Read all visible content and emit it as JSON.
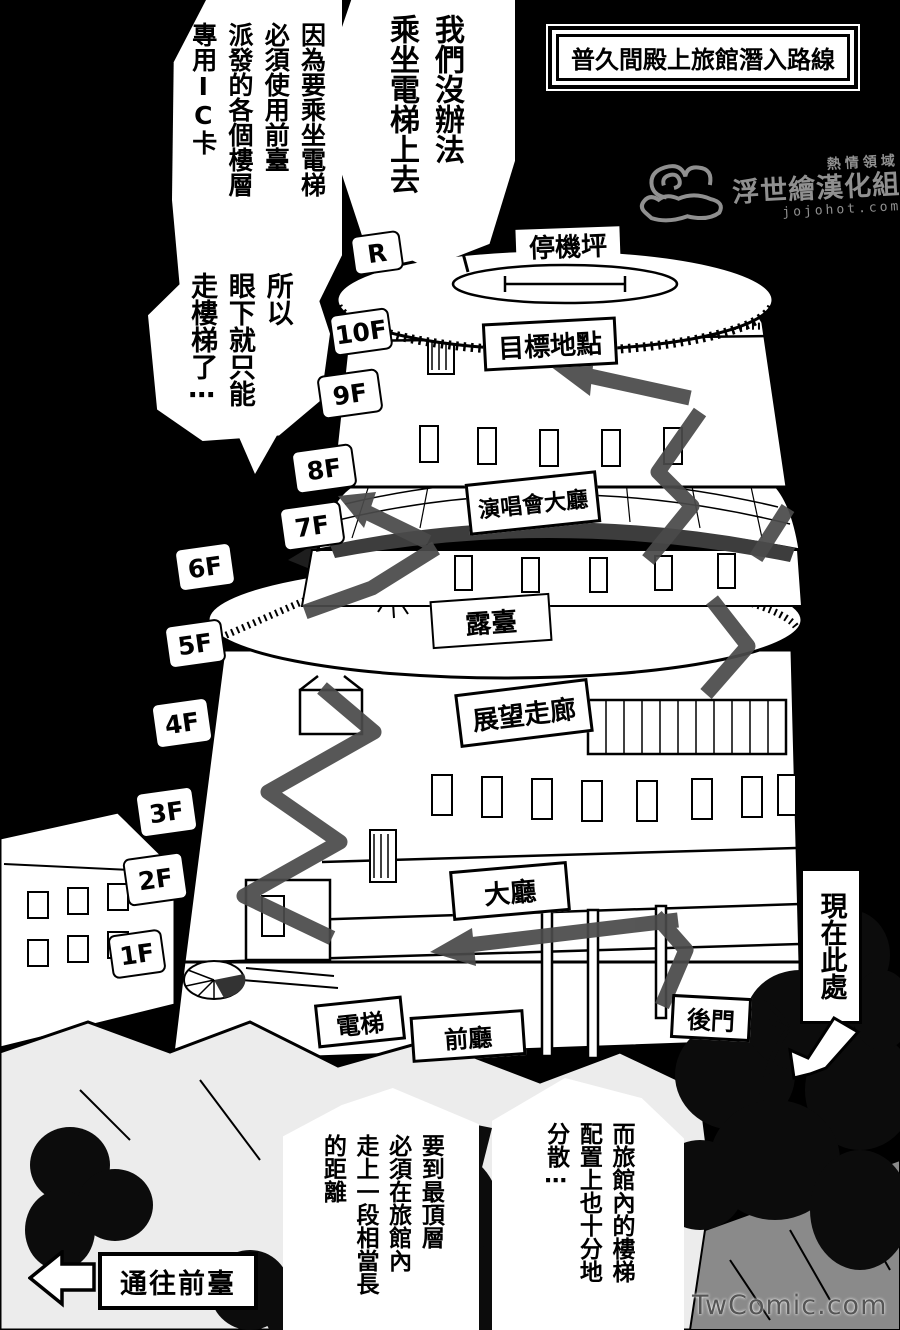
{
  "page": {
    "title": "普久間殿上旅館潛入路線",
    "site_credit": "TwComic.com"
  },
  "watermark": {
    "line1": "熱情領域",
    "line2": "浮世繪漢化組",
    "line3": "jojohot.com"
  },
  "bubbles": {
    "no_elevator": "我們沒辦法\n乘坐電梯上去",
    "ic_card": "因為要乘坐電梯\n必須使用前臺\n派發的各個樓層\n專用IC卡",
    "take_stairs": "所以\n眼下就只能\n走樓梯了⋯",
    "long_distance": "要到最頂層\n必須在旅館內\n走上一段相當長\n的距離",
    "scattered_stairs": "而旅館內的樓梯\n配置上也十分地\n分散⋯"
  },
  "floors": [
    "R",
    "10F",
    "9F",
    "8F",
    "7F",
    "6F",
    "5F",
    "4F",
    "3F",
    "2F",
    "1F"
  ],
  "labels": {
    "helipad": "停機坪",
    "target": "目標地點",
    "concert_hall": "演唱會大廳",
    "terrace": "露臺",
    "observation_corridor": "展望走廊",
    "lobby": "大廳",
    "elevator": "電梯",
    "front_hall": "前廳",
    "back_door": "後門",
    "current_location": "現在此處",
    "to_front_desk": "通往前臺"
  },
  "colors": {
    "paper": "#ffffff",
    "ink": "#000000",
    "route_arrow": "#4a4a4a",
    "watermark": "#909090"
  }
}
